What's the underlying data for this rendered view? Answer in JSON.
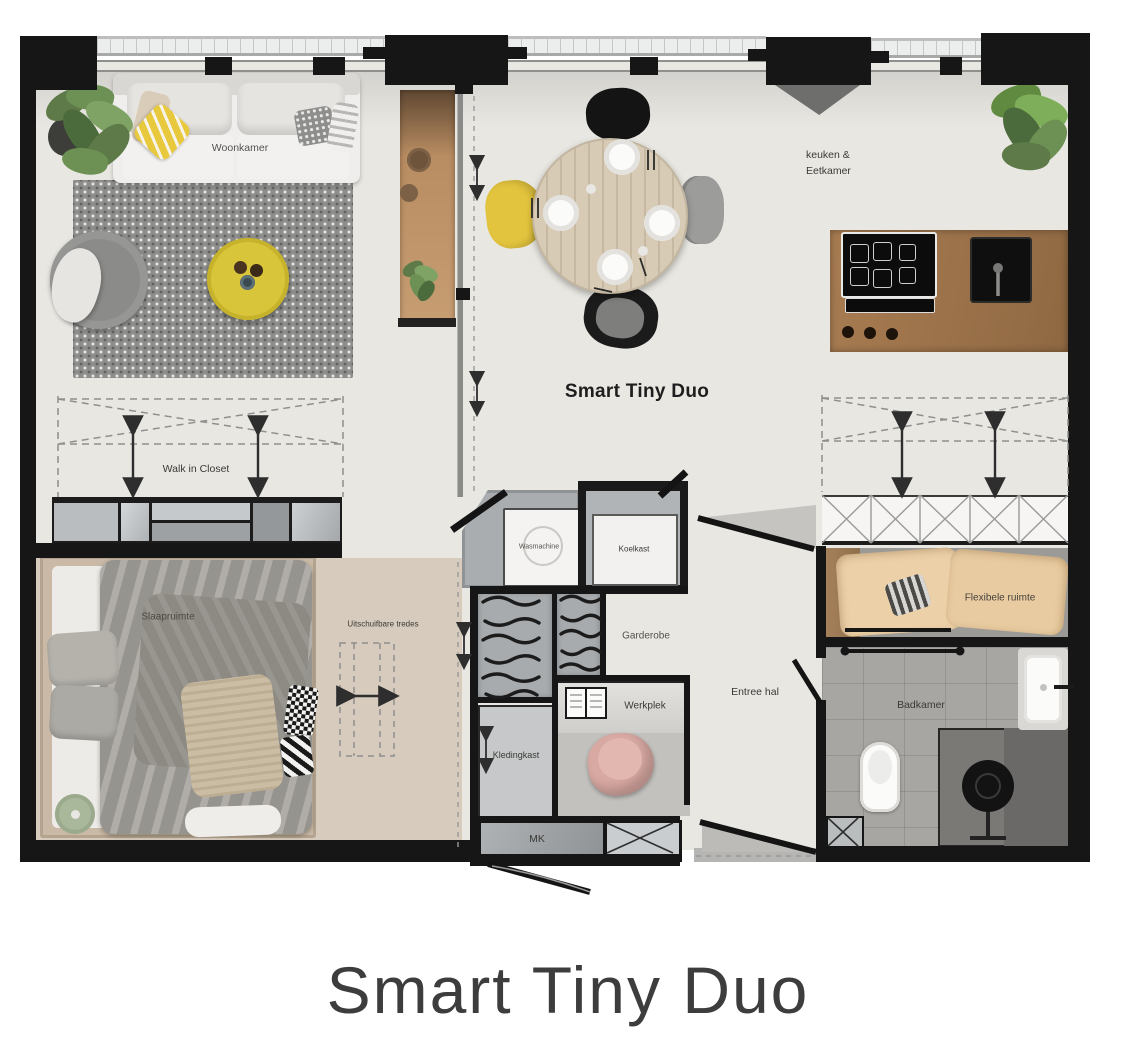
{
  "page": {
    "title": "Smart Tiny Duo"
  },
  "plan": {
    "title": "Smart Tiny Duo",
    "rooms": {
      "woonkamer": {
        "label": "Woonkamer"
      },
      "keuken_eetkamer": {
        "label_line1": "keuken &",
        "label_line2": "Eetkamer"
      },
      "walk_in_closet": {
        "label": "Walk in Closet"
      },
      "slaapruimte": {
        "label": "Slaapruimte"
      },
      "entree_hal": {
        "label": "Entree hal"
      },
      "flexibele_ruimte": {
        "label": "Flexibele ruimte"
      },
      "badkamer": {
        "label": "Badkamer"
      }
    },
    "features": {
      "uitschuifbare_tredes": {
        "label": "Uitschuifbare tredes"
      },
      "wasmachine": {
        "label": "Wasmachine"
      },
      "koelkast": {
        "label": "Koelkast"
      },
      "garderobe": {
        "label": "Garderobe"
      },
      "kledingkast": {
        "label": "Kledingkast"
      },
      "werkplek": {
        "label": "Werkplek"
      },
      "meterkast": {
        "label": "MK"
      }
    },
    "colors": {
      "wall": "#161616",
      "floor": "#e9e7e2",
      "bedroom_floor": "#d6cbbc",
      "accent_yellow": "#d9c53a",
      "wood": "#a87c52",
      "rug_gray": "#8d8d8b",
      "bathroom_gray": "#a8a6a3",
      "chair_pink": "#d8a8a2",
      "plant_green": "#6d9154"
    }
  }
}
